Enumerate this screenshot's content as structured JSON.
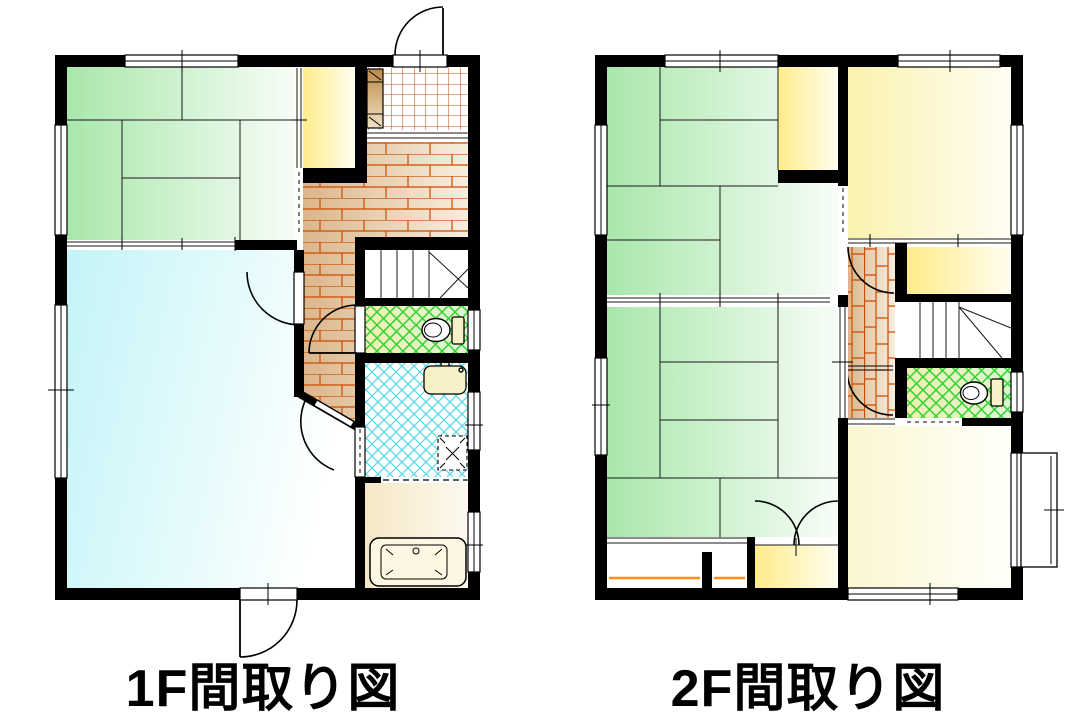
{
  "captions": {
    "floor1": "1F間取り図",
    "floor2": "2F間取り図"
  },
  "palette": {
    "wall": "#000000",
    "line": "#1a1a1a",
    "tatami_deep": "#a9e7ab",
    "tatami_pale": "#f7fdf7",
    "water_deep": "#c3f4f8",
    "water_pale": "#feffff",
    "closet_deep": "#ffec8a",
    "closet_pale": "#fffdf0",
    "western_deep": "#faf2ad",
    "western_pale": "#fffdf4",
    "cream_deep": "#fbf6d2",
    "cream_pale": "#fffffa",
    "hall_deep": "#dbb68b",
    "hall_pale": "#f7eedf",
    "brick_line": "#cc4b00",
    "tile_line": "#c75618",
    "toilet_deep": "#f1efb2",
    "toilet_pale": "#dcf6d4",
    "toilet_hatch": "#2fd32f",
    "wash_hatch": "#56d8e2",
    "bath_deep": "#f6e8c6",
    "bath_pale": "#fdf9ef",
    "fixture_fill": "#f8f1c8",
    "tub_fill": "#fdf6e2",
    "cabinet_deep": "#bd8a4a",
    "cabinet_pale": "#f1e1c2",
    "pole": "#ff8d1f"
  }
}
